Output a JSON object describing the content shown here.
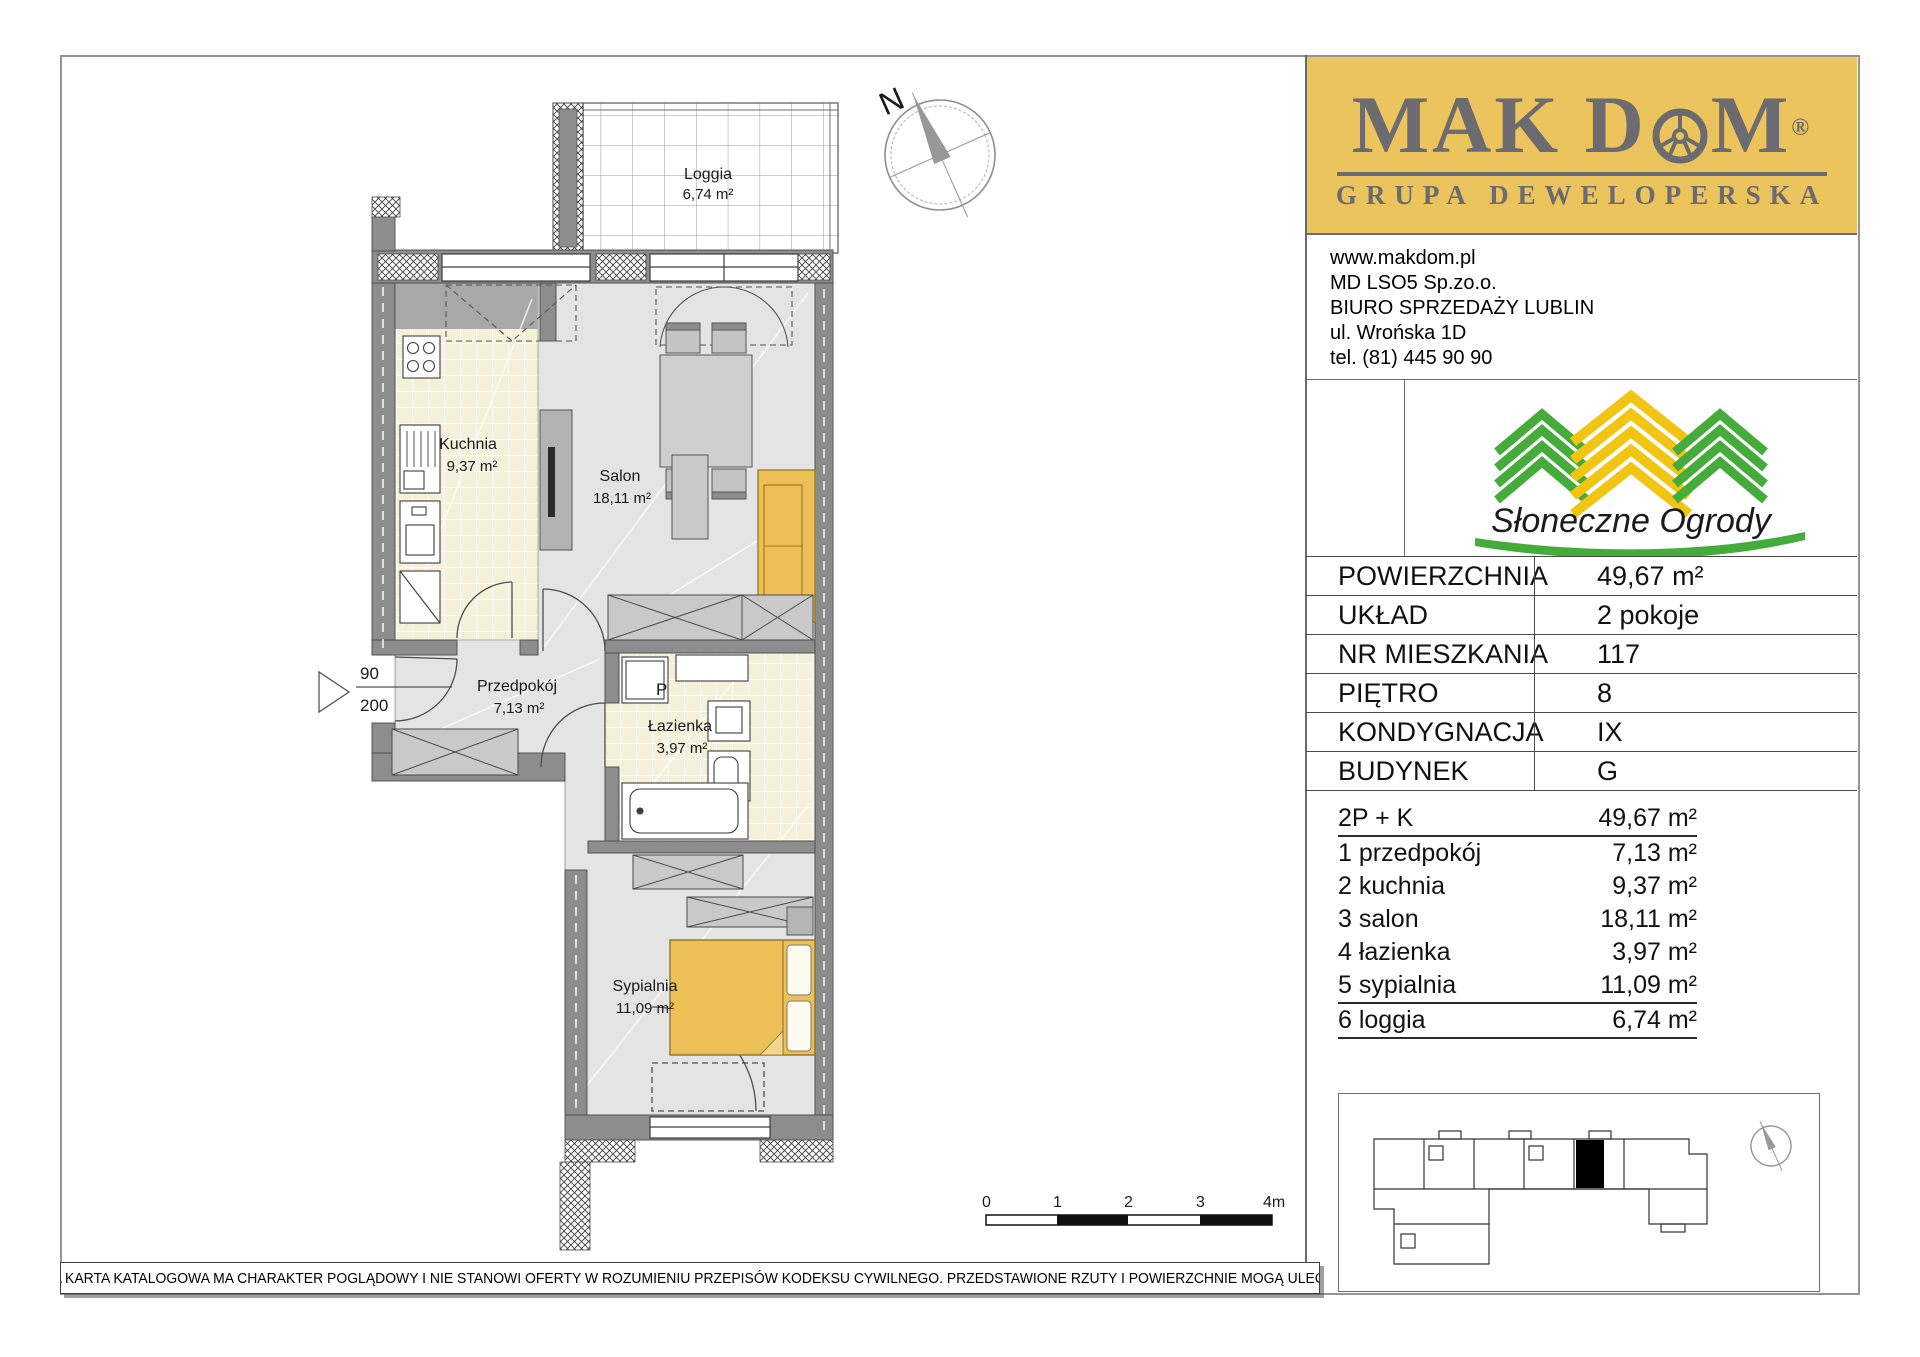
{
  "brand": {
    "name_left": "MAK D",
    "name_right": "M",
    "registered": "®",
    "tagline": "GRUPA DEWELOPERSKA",
    "bg_color": "#ecc45e",
    "fg_color": "#6b6b70"
  },
  "contact": {
    "website": "www.makdom.pl",
    "company": "MD LSO5 Sp.zo.o.",
    "office": "BIURO SPRZEDAŻY LUBLIN",
    "street": "ul. Wrońska 1D",
    "phone": "tel. (81) 445 90 90"
  },
  "estate": {
    "name": "Słoneczne Ogrody",
    "green": "#45ab3a",
    "yellow": "#f3c513"
  },
  "specs": {
    "rows": [
      {
        "label": "POWIERZCHNIA",
        "value": "49,67 m²"
      },
      {
        "label": "UKŁAD",
        "value": "2 pokoje"
      },
      {
        "label": "NR MIESZKANIA",
        "value": "117"
      },
      {
        "label": "PIĘTRO",
        "value": "8"
      },
      {
        "label": "KONDYGNACJA",
        "value": "IX"
      },
      {
        "label": "BUDYNEK",
        "value": "G"
      }
    ]
  },
  "rooms": {
    "header": {
      "label": "2P + K",
      "area": "49,67 m²"
    },
    "items": [
      {
        "label": "1 przedpokój",
        "area": "7,13 m²"
      },
      {
        "label": "2 kuchnia",
        "area": "9,37 m²"
      },
      {
        "label": "3 salon",
        "area": "18,11 m²"
      },
      {
        "label": "4 łazienka",
        "area": "3,97 m²"
      },
      {
        "label": "5 sypialnia",
        "area": "11,09 m²"
      },
      {
        "label": "6 loggia",
        "area": "6,74 m²"
      }
    ]
  },
  "plan": {
    "compass": "N",
    "loggia": {
      "name": "Loggia",
      "area": "6,74 m²"
    },
    "kuchnia": {
      "name": "Kuchnia",
      "area": "9,37 m²"
    },
    "salon": {
      "name": "Salon",
      "area": "18,11 m²"
    },
    "przedpokoj": {
      "name": "Przedpokój",
      "area": "7,13 m²"
    },
    "lazienka": {
      "name": "Łazienka",
      "area": "3,97 m²"
    },
    "sypialnia": {
      "name": "Sypialnia",
      "area": "11,09 m²"
    },
    "door_width": "90",
    "door_height": "200",
    "washer": "P",
    "sofa_color": "#ecbf57",
    "bed_color": "#ecbf57"
  },
  "scalebar": {
    "ticks": [
      "0",
      "1",
      "2",
      "3",
      "4m"
    ]
  },
  "footer": {
    "disclaimer": "NINIEJSZA KARTA KATALOGOWA MA CHARAKTER POGLĄDOWY I NIE STANOWI OFERTY W ROZUMIENIU PRZEPISÓW KODEKSU CYWILNEGO. PRZEDSTAWIONE RZUTY I POWIERZCHNIE MOGĄ ULEC ZMIANIE."
  }
}
